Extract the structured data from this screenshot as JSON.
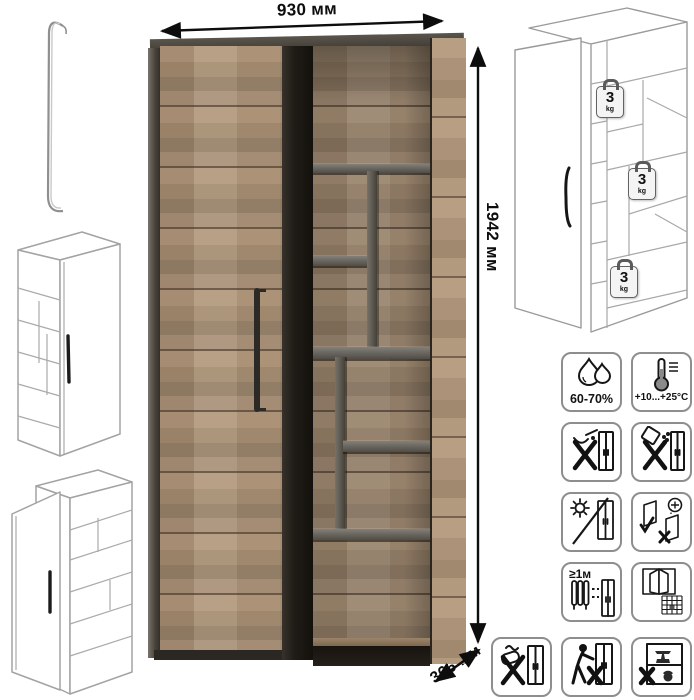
{
  "page": {
    "background": "#ffffff"
  },
  "product": {
    "type": "wardrobe-shelf-unit"
  },
  "dimensions": {
    "width": {
      "label": "930 мм"
    },
    "height": {
      "label": "1942 мм"
    },
    "depth": {
      "label": "366 мм"
    }
  },
  "technical_view": {
    "shelf_load_badges": [
      {
        "value": "3",
        "unit": "kg"
      },
      {
        "value": "3",
        "unit": "kg"
      },
      {
        "value": "3",
        "unit": "kg"
      }
    ]
  },
  "care_icons": [
    {
      "name": "humidity-range",
      "label": "60-70%"
    },
    {
      "name": "temperature-range",
      "label": "+10...+25°C"
    },
    {
      "name": "no-liquids"
    },
    {
      "name": "no-abrasive-powder"
    },
    {
      "name": "no-direct-sunlight"
    },
    {
      "name": "door-hinge-adjustment"
    },
    {
      "name": "keep-1m-from-heaters",
      "label": "≥1м"
    },
    {
      "name": "ventilate-room"
    },
    {
      "name": "no-harsh-scrubbing"
    },
    {
      "name": "no-dragging"
    },
    {
      "name": "no-overloading"
    }
  ],
  "colors": {
    "wood_light": "#b39a7e",
    "wood_mid": "#a68e73",
    "wood_dark": "#99836b",
    "graphite": "#55524b",
    "outline_gray": "#a0a0a0",
    "text": "#111111"
  }
}
